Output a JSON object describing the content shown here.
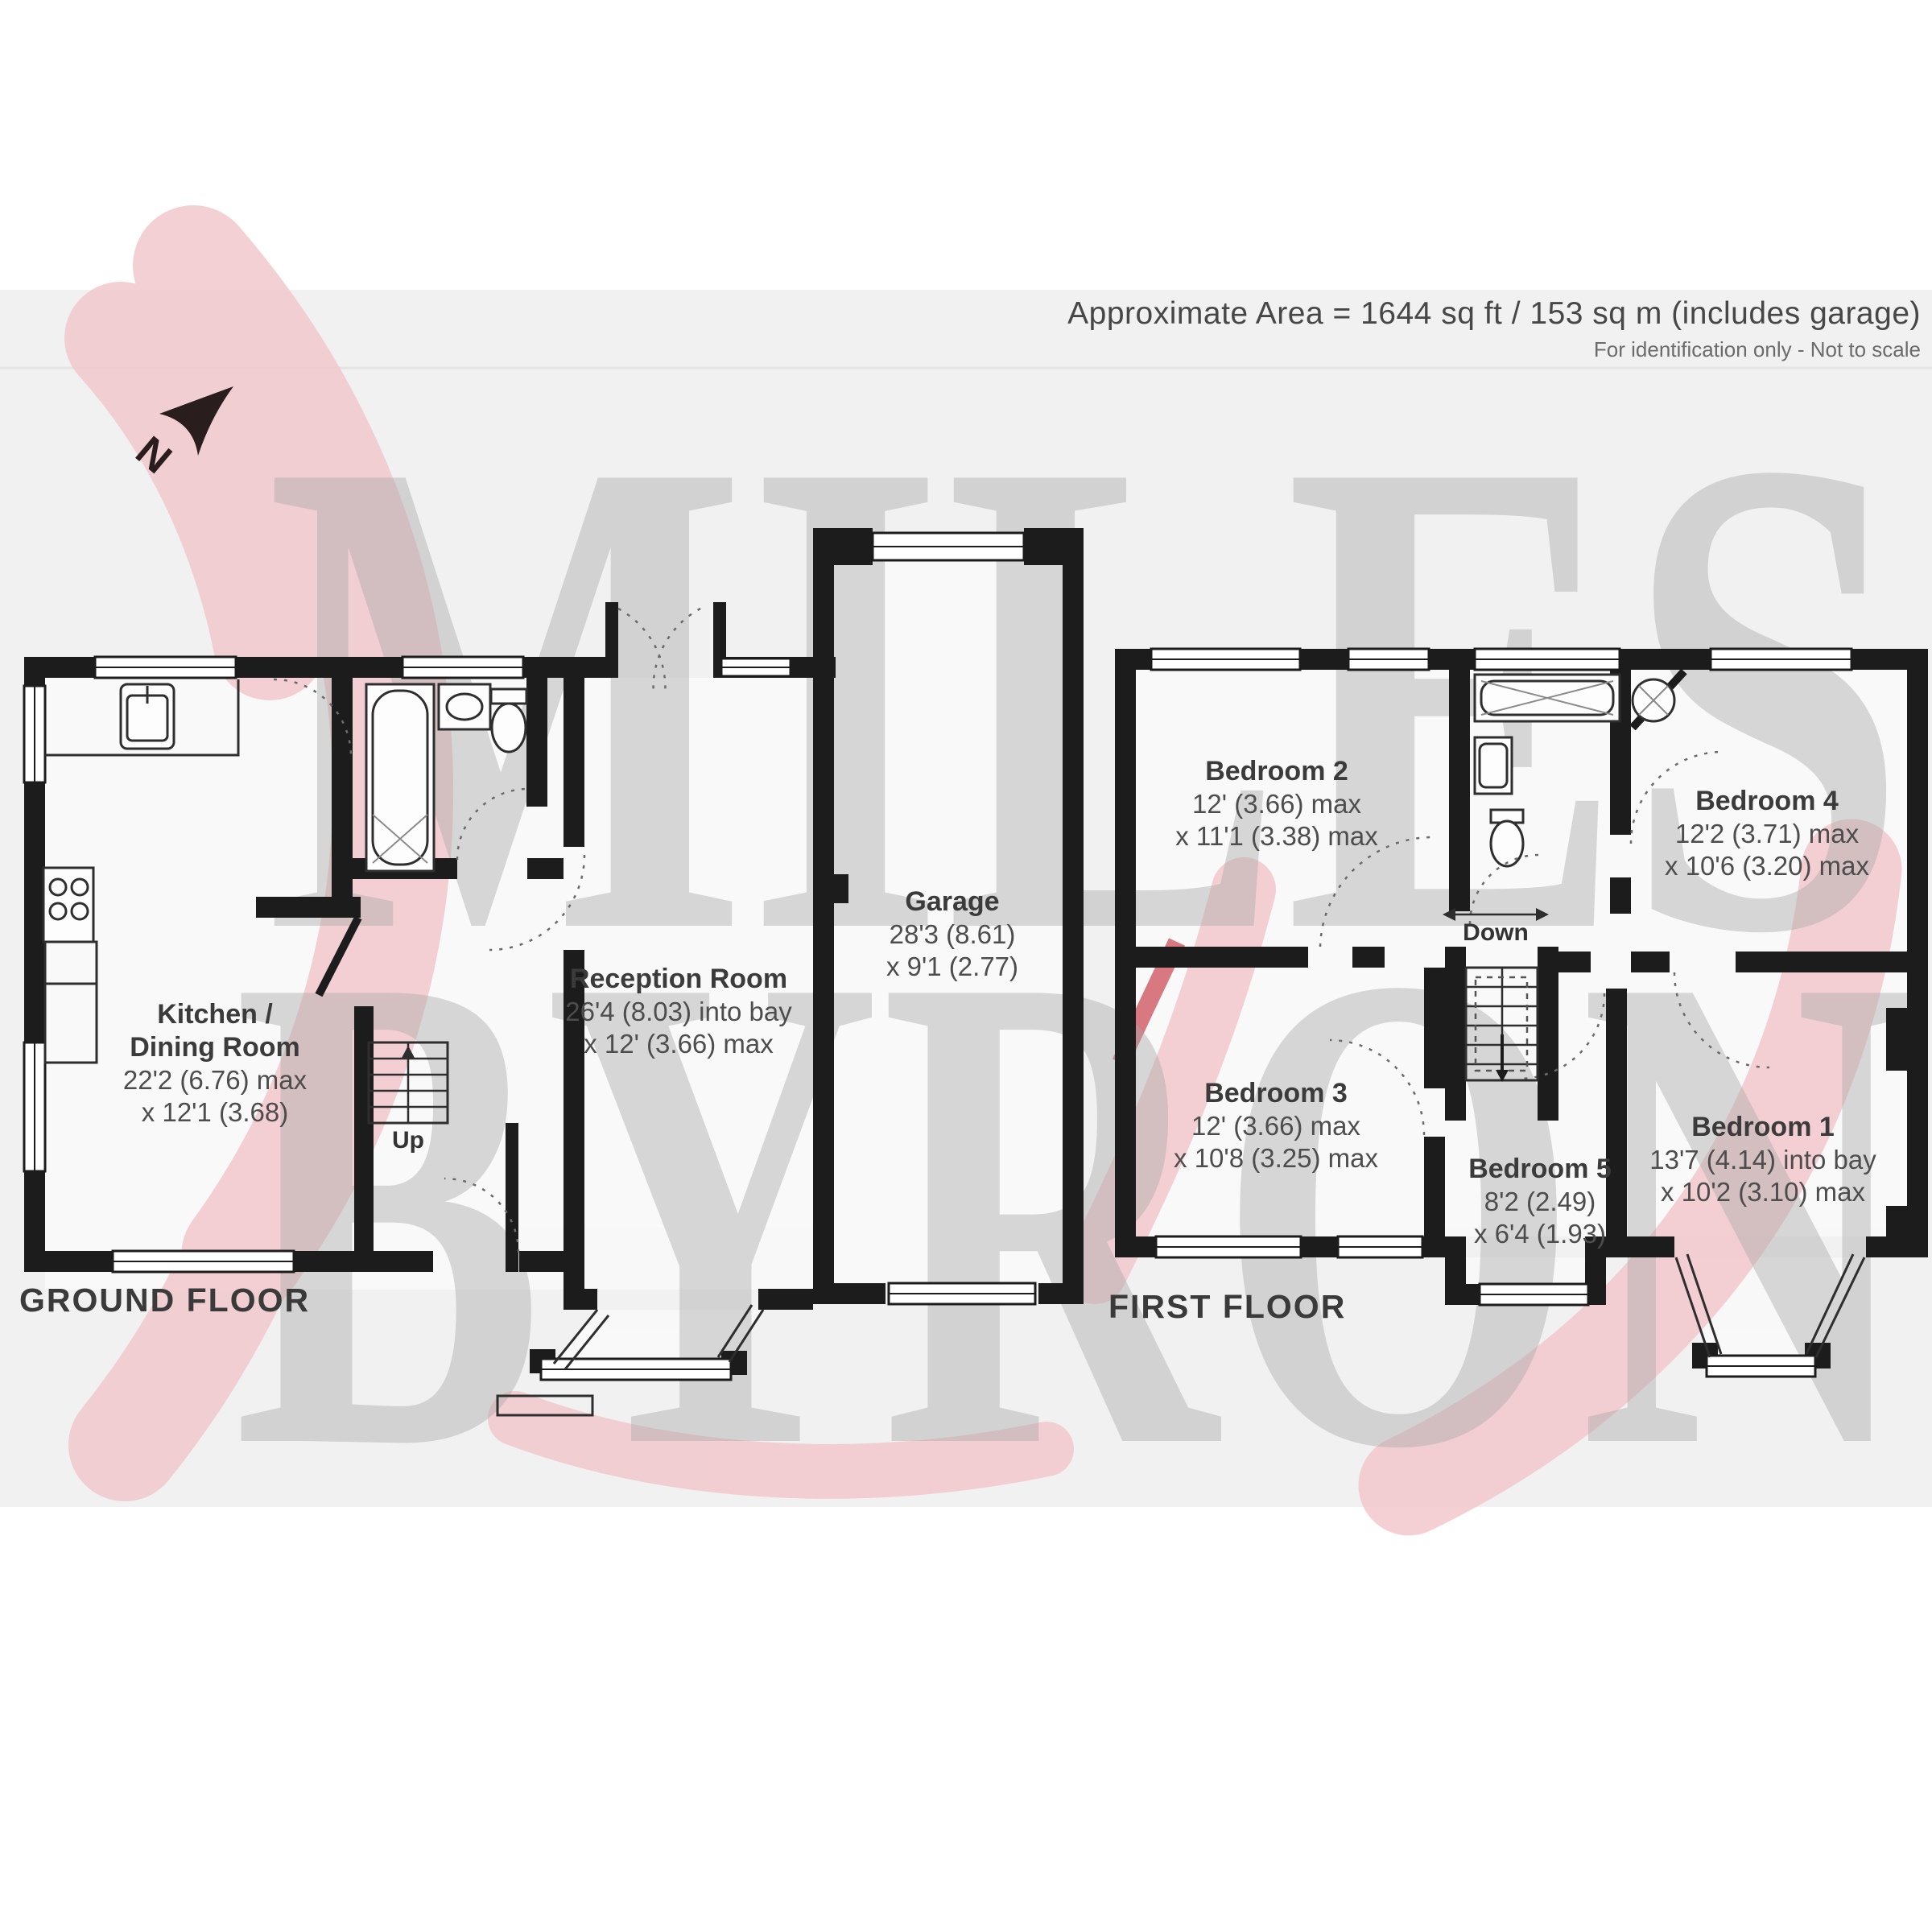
{
  "header": {
    "area_text": "Approximate Area = 1644 sq ft / 153 sq m (includes garage)",
    "disclaimer": "For identification only - Not to scale"
  },
  "watermark": {
    "line1": "MILES",
    "line2": "BYRON"
  },
  "north_label": "N",
  "colors": {
    "wall": "#1c1c1c",
    "watermark_gray": "#a8a8a8",
    "watermark_pink": "#f2c8cd",
    "background_tint": "#f1f1f2"
  },
  "ground_floor": {
    "label": "GROUND FLOOR",
    "stairs_label": "Up",
    "rooms": {
      "kitchen": {
        "name": "Kitchen /",
        "name2": "Dining Room",
        "dim1": "22'2 (6.76) max",
        "dim2": "x 12'1 (3.68)"
      },
      "reception": {
        "name": "Reception Room",
        "dim1": "26'4 (8.03) into bay",
        "dim2": "x 12' (3.66) max"
      },
      "garage": {
        "name": "Garage",
        "dim1": "28'3 (8.61)",
        "dim2": "x 9'1 (2.77)"
      }
    }
  },
  "first_floor": {
    "label": "FIRST FLOOR",
    "stairs_label": "Down",
    "rooms": {
      "bedroom2": {
        "name": "Bedroom 2",
        "dim1": "12' (3.66) max",
        "dim2": "x 11'1 (3.38) max"
      },
      "bedroom4": {
        "name": "Bedroom 4",
        "dim1": "12'2 (3.71) max",
        "dim2": "x 10'6 (3.20) max"
      },
      "bedroom3": {
        "name": "Bedroom 3",
        "dim1": "12' (3.66) max",
        "dim2": "x 10'8 (3.25) max"
      },
      "bedroom5": {
        "name": "Bedroom 5",
        "dim1": "8'2 (2.49)",
        "dim2": "x 6'4 (1.93)"
      },
      "bedroom1": {
        "name": "Bedroom 1",
        "dim1": "13'7 (4.14) into bay",
        "dim2": "x 10'2 (3.10) max"
      }
    }
  }
}
